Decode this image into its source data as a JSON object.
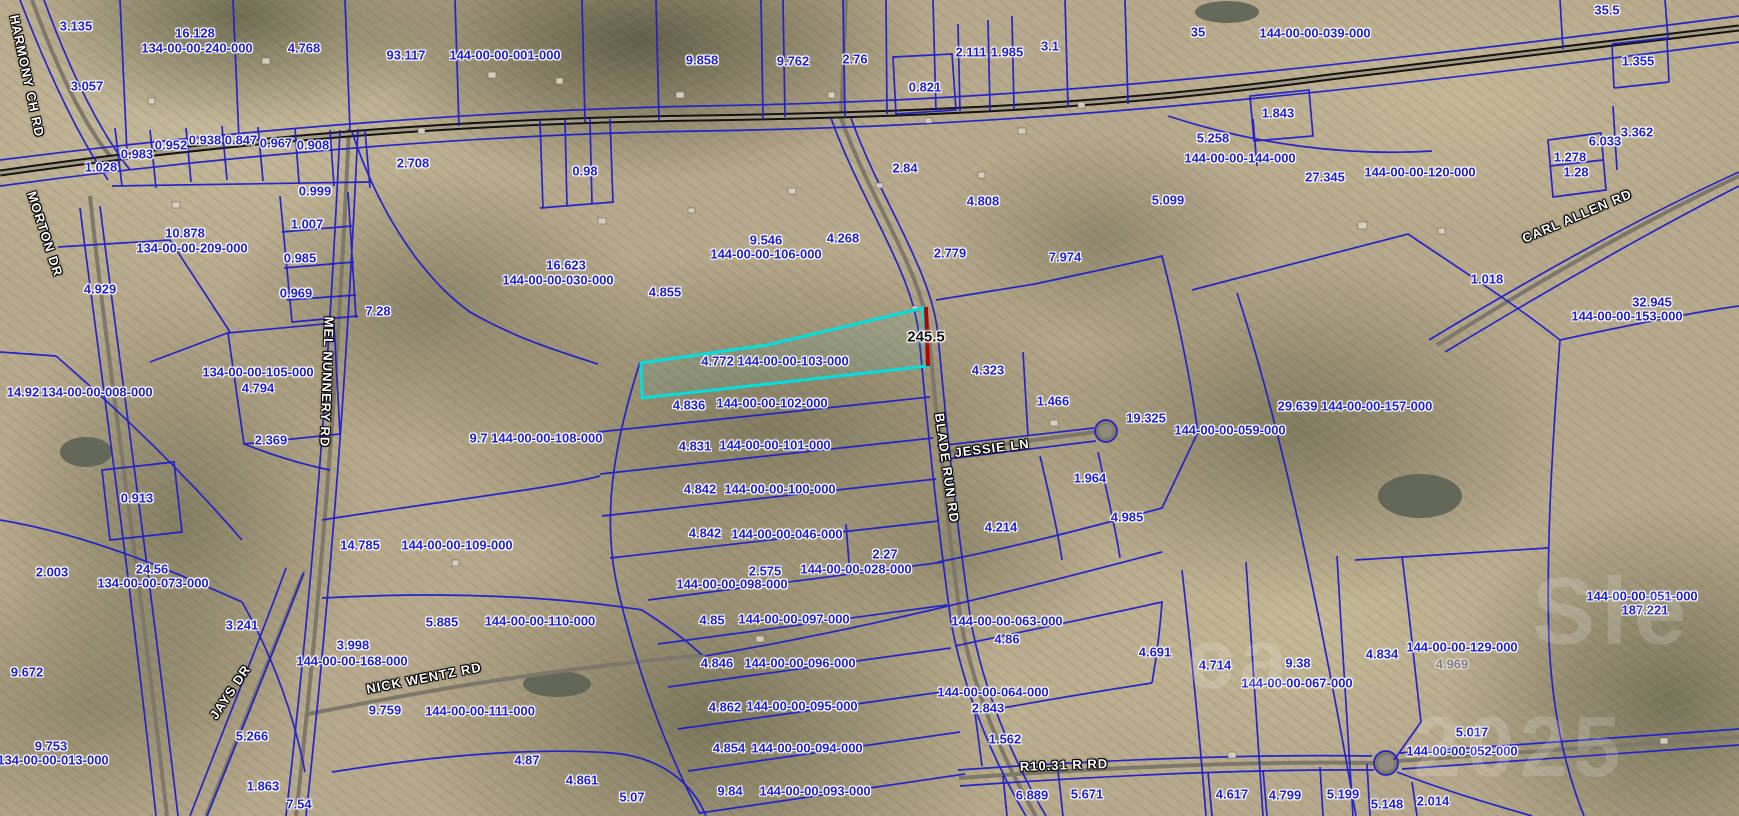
{
  "map": {
    "colors": {
      "parcel_blue": "#1e1ecb",
      "highlight_cyan": "#00dede",
      "dimension_red": "#b30000",
      "road_black": "#14120e",
      "road_gray": "#7d786a"
    },
    "highlight": {
      "parcel_label": "4.772 144-00-00-103-000",
      "dimension": {
        "t": "245.5",
        "x": 926,
        "y": 337
      }
    },
    "parcel_labels": [
      [
        "3.135",
        76,
        26
      ],
      [
        "16.128",
        195,
        33
      ],
      [
        "134-00-00-240-000",
        197,
        48
      ],
      [
        "4.768",
        304,
        48
      ],
      [
        "93.117",
        406,
        55
      ],
      [
        "144-00-00-001-000",
        505,
        55
      ],
      [
        "9.858",
        702,
        60
      ],
      [
        "9.762",
        793,
        61
      ],
      [
        "2.76",
        855,
        59
      ],
      [
        "0.821",
        925,
        87
      ],
      [
        "2.111",
        971,
        52
      ],
      [
        "1.985",
        1007,
        52
      ],
      [
        "3.1",
        1050,
        46
      ],
      [
        "35",
        1198,
        32
      ],
      [
        "144-00-00-039-000",
        1315,
        33
      ],
      [
        "35.5",
        1607,
        10
      ],
      [
        "1.355",
        1638,
        61
      ],
      [
        "1.843",
        1278,
        113
      ],
      [
        "5.258",
        1213,
        138
      ],
      [
        "144-00-00-144-000",
        1240,
        158
      ],
      [
        "27.345",
        1325,
        177
      ],
      [
        "144-00-00-120-000",
        1420,
        172
      ],
      [
        "6.033",
        1605,
        141
      ],
      [
        "3.362",
        1637,
        132
      ],
      [
        "1.278",
        1570,
        157
      ],
      [
        "1.28",
        1576,
        172
      ],
      [
        "3.057",
        87,
        86
      ],
      [
        "1.028",
        101,
        167
      ],
      [
        "0.983",
        137,
        154
      ],
      [
        "0.952",
        171,
        145
      ],
      [
        "0.938",
        205,
        140
      ],
      [
        "0.847",
        241,
        140
      ],
      [
        "0.967",
        276,
        143
      ],
      [
        "0.908",
        313,
        145
      ],
      [
        "2.708",
        413,
        163
      ],
      [
        "0.98",
        585,
        171
      ],
      [
        "2.84",
        905,
        168
      ],
      [
        "4.808",
        983,
        201
      ],
      [
        "5.099",
        1168,
        200
      ],
      [
        "7.974",
        1065,
        257
      ],
      [
        "0.999",
        315,
        191
      ],
      [
        "1.007",
        307,
        224
      ],
      [
        "0.985",
        300,
        258
      ],
      [
        "0.969",
        296,
        293
      ],
      [
        "10.878",
        185,
        233
      ],
      [
        "134-00-00-209-000",
        192,
        248
      ],
      [
        "4.929",
        100,
        289
      ],
      [
        "7.28",
        378,
        311
      ],
      [
        "16.623",
        566,
        265
      ],
      [
        "144-00-00-030-000",
        558,
        280
      ],
      [
        "9.546",
        766,
        240
      ],
      [
        "144-00-00-106-000",
        766,
        254
      ],
      [
        "4.268",
        843,
        238
      ],
      [
        "2.779",
        950,
        253
      ],
      [
        "4.855",
        665,
        292
      ],
      [
        "CARL",
        0,
        -100
      ],
      [
        "32.945",
        1652,
        302
      ],
      [
        "144-00-00-153-000",
        1627,
        316
      ],
      [
        "1.018",
        1487,
        279
      ],
      [
        "134-00-00-105-000",
        258,
        372
      ],
      [
        "4.794",
        258,
        388
      ],
      [
        "14.92",
        23,
        392
      ],
      [
        "134-00-00-008-000",
        97,
        392
      ],
      [
        "2.369",
        271,
        440
      ],
      [
        "0.913",
        137,
        498
      ],
      [
        "9.7 144-00-00-108-000",
        536,
        438
      ],
      [
        "4.836",
        689,
        405
      ],
      [
        "144-00-00-102-000",
        772,
        403
      ],
      [
        "4.831",
        695,
        446
      ],
      [
        "144-00-00-101-000",
        775,
        445
      ],
      [
        "4.842",
        700,
        489
      ],
      [
        "144-00-00-100-000",
        780,
        489
      ],
      [
        "4.842",
        705,
        533
      ],
      [
        "144-00-00-046-000",
        787,
        534
      ],
      [
        "4.323",
        988,
        370
      ],
      [
        "1.466",
        1053,
        401
      ],
      [
        "19.325",
        1146,
        418
      ],
      [
        "144-00-00-059-000",
        1230,
        430
      ],
      [
        "1.964",
        1090,
        478
      ],
      [
        "4.985",
        1127,
        517
      ],
      [
        "4.214",
        1001,
        527
      ],
      [
        "29.639 144-00-00-157-000",
        1355,
        406
      ],
      [
        "2.27",
        885,
        554
      ],
      [
        "144-00-00-028-000",
        856,
        569
      ],
      [
        "2.575",
        765,
        571
      ],
      [
        "144-00-00-098-000",
        732,
        584
      ],
      [
        "4.85",
        712,
        620
      ],
      [
        "144-00-00-097-000",
        794,
        619
      ],
      [
        "4.846",
        717,
        663
      ],
      [
        "144-00-00-096-000",
        800,
        663
      ],
      [
        "4.862",
        725,
        707
      ],
      [
        "144-00-00-095-000",
        802,
        706
      ],
      [
        "4.854",
        729,
        748
      ],
      [
        "144-00-00-094-000",
        807,
        748
      ],
      [
        "9.84",
        730,
        791
      ],
      [
        "144-00-00-093-000",
        815,
        791
      ],
      [
        "14.785",
        360,
        545
      ],
      [
        "144-00-00-109-000",
        457,
        545
      ],
      [
        "24.56",
        152,
        569
      ],
      [
        "134-00-00-073-000",
        153,
        583
      ],
      [
        "2.003",
        52,
        572
      ],
      [
        "9.672",
        27,
        672
      ],
      [
        "9.753",
        51,
        746
      ],
      [
        "134-00-00-013-000",
        53,
        760
      ],
      [
        "3.241",
        242,
        625
      ],
      [
        "5.266",
        252,
        736
      ],
      [
        "1.863",
        263,
        786
      ],
      [
        "7.54",
        299,
        804
      ],
      [
        "5.885",
        442,
        622
      ],
      [
        "144-00-00-110-000",
        540,
        621
      ],
      [
        "3.998",
        353,
        645
      ],
      [
        "144-00-00-168-000",
        352,
        661
      ],
      [
        "9.759",
        385,
        710
      ],
      [
        "144-00-00-111-000",
        480,
        711
      ],
      [
        "4.87",
        527,
        760
      ],
      [
        "4.861",
        582,
        780
      ],
      [
        "5.07",
        632,
        797
      ],
      [
        "144-00-00-063-000",
        1007,
        621
      ],
      [
        "4.86",
        1007,
        639
      ],
      [
        "144-00-00-064-000",
        993,
        692
      ],
      [
        "2.843",
        988,
        708
      ],
      [
        "1.562",
        1005,
        739
      ],
      [
        "6.889",
        1032,
        795
      ],
      [
        "5.671",
        1087,
        794
      ],
      [
        "4.691",
        1155,
        652
      ],
      [
        "4.714",
        1215,
        665
      ],
      [
        "9.38",
        1298,
        663
      ],
      [
        "144-00-00-067-000",
        1297,
        683
      ],
      [
        "4.834",
        1382,
        654
      ],
      [
        "144-00-00-129-000",
        1462,
        647
      ],
      [
        "4.969",
        1452,
        664,
        "dim"
      ],
      [
        "144-00-00-051-000",
        1642,
        596
      ],
      [
        "187.221",
        1645,
        610
      ],
      [
        "5.017",
        1472,
        732
      ],
      [
        "144-00-00-052-000",
        1462,
        751
      ],
      [
        "4.617",
        1232,
        794
      ],
      [
        "4.799",
        1285,
        795
      ],
      [
        "5.199",
        1343,
        794
      ],
      [
        "5.148",
        1387,
        804
      ],
      [
        "2.014",
        1433,
        801
      ]
    ],
    "road_labels": [
      [
        "HARMONY CH RD",
        27,
        76,
        78
      ],
      [
        "MORTON DR",
        45,
        234,
        72
      ],
      [
        "MEL NUNNERY RD",
        327,
        382,
        92
      ],
      [
        "BLADE RUN RD",
        947,
        468,
        82
      ],
      [
        "JESSIE LN",
        992,
        448,
        -7
      ],
      [
        "NICK WENTZ RD",
        424,
        678,
        -11
      ],
      [
        "JAYS DR",
        230,
        692,
        -56
      ],
      [
        "CARL ALLEN RD",
        1577,
        216,
        -23
      ],
      [
        "R10.31 R RD",
        1064,
        765,
        -2
      ]
    ],
    "watermark_fragments": [
      [
        "Sle",
        1612,
        612,
        95
      ],
      [
        "ca",
        1240,
        660,
        85
      ],
      [
        "2025",
        1520,
        748,
        85
      ]
    ]
  }
}
